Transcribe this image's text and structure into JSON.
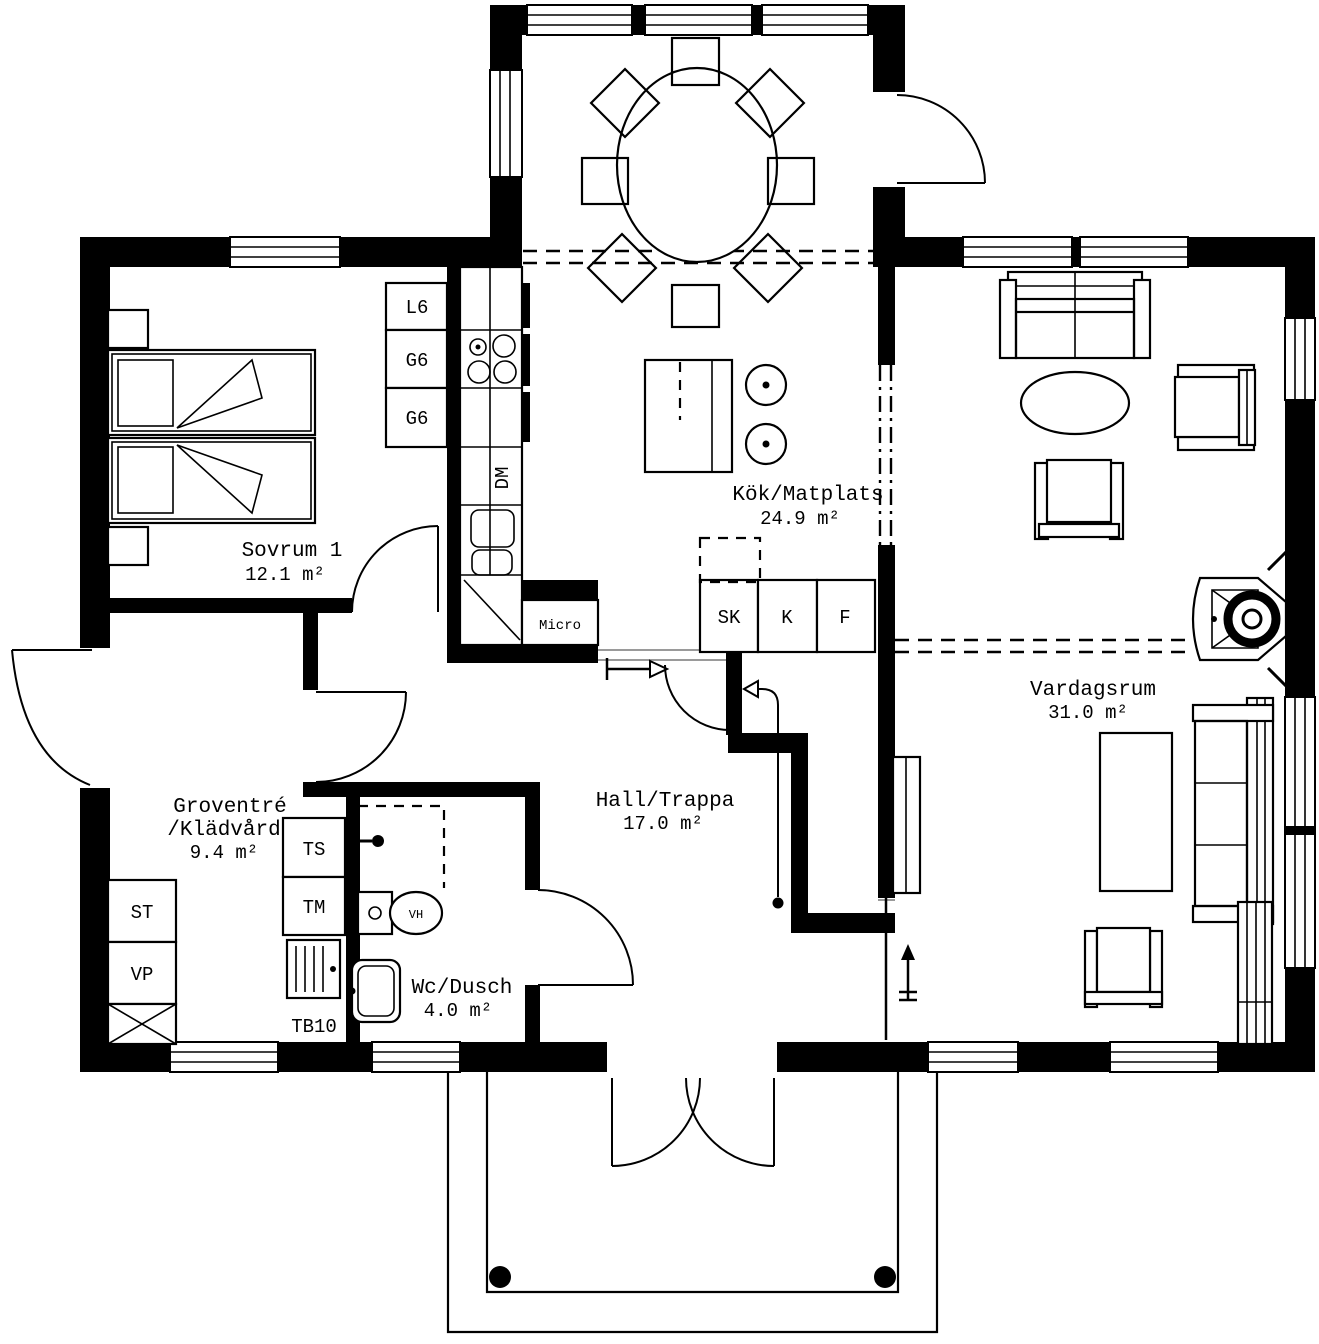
{
  "plan": {
    "rooms": {
      "sovrum1": {
        "name": "Sovrum 1",
        "area": "12.1 m²"
      },
      "kok": {
        "name": "Kök/Matplats",
        "area": "24.9 m²"
      },
      "vardagsrum": {
        "name": "Vardagsrum",
        "area": "31.0 m²"
      },
      "groventre": {
        "name_line1": "Groventré",
        "name_line2": "/Klädvård",
        "area": "9.4 m²"
      },
      "hall": {
        "name": "Hall/Trappa",
        "area": "17.0 m²"
      },
      "wc": {
        "name": "Wc/Dusch",
        "area": "4.0 m²"
      }
    },
    "fixtures": {
      "l6": "L6",
      "g6_upper": "G6",
      "g6_lower": "G6",
      "dm": "DM",
      "micro": "Micro",
      "sk": "SK",
      "kyl": "K",
      "frys": "F",
      "ts": "TS",
      "tm": "TM",
      "tb10": "TB10",
      "st": "ST",
      "vp": "VP",
      "vh": "VH"
    },
    "colors": {
      "wall": "#000000",
      "background": "#ffffff"
    }
  }
}
